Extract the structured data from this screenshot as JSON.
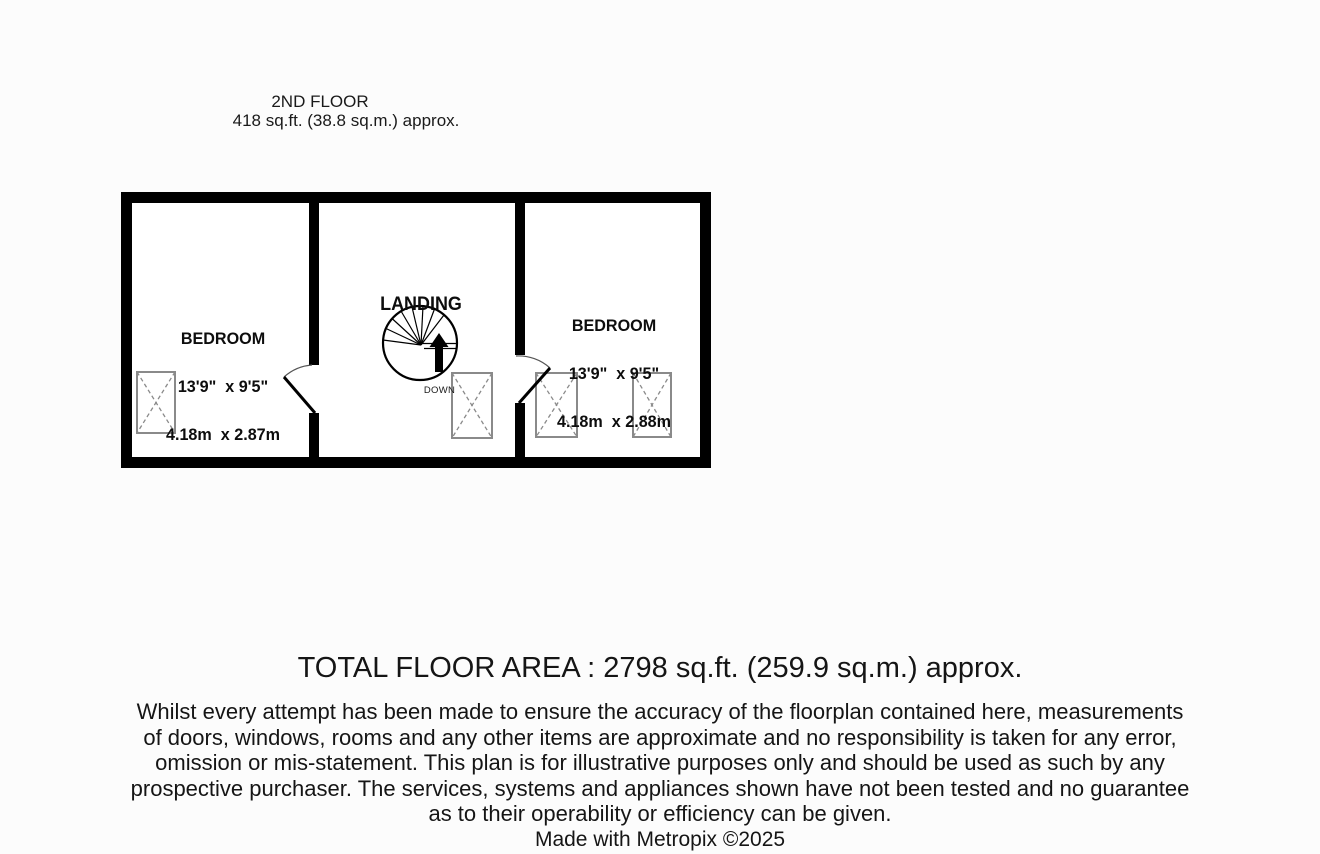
{
  "header": {
    "floor_label": "2ND FLOOR",
    "floor_area": "418 sq.ft. (38.8 sq.m.) approx."
  },
  "floorplan": {
    "rooms": [
      {
        "name": "BEDROOM",
        "dim_imperial": "13'9\"  x 9'5\"",
        "dim_metric": "4.18m  x 2.87m"
      },
      {
        "name": "LANDING",
        "dim_imperial": "",
        "dim_metric": ""
      },
      {
        "name": "BEDROOM",
        "dim_imperial": "13'9\"  x 9'5\"",
        "dim_metric": "4.18m  x 2.88m"
      }
    ],
    "stairs_label": "DOWN"
  },
  "footer": {
    "total_area": "TOTAL FLOOR AREA : 2798 sq.ft. (259.9 sq.m.) approx.",
    "disclaimer_lines": [
      "Whilst every attempt has been made to ensure the accuracy of the floorplan contained here, measurements",
      "of doors, windows, rooms and any other items are approximate and no responsibility is taken for any error,",
      "omission or mis-statement. This plan is for illustrative purposes only and should be used as such by any",
      "prospective purchaser. The services, systems and appliances shown have not been tested and no guarantee",
      "as to their operability or efficiency can be given."
    ],
    "credit": "Made with Metropix ©2025"
  },
  "colors": {
    "wall": "#000000",
    "window_outline": "#8a8a8a",
    "door_arc": "#555555",
    "text": "#151515"
  }
}
